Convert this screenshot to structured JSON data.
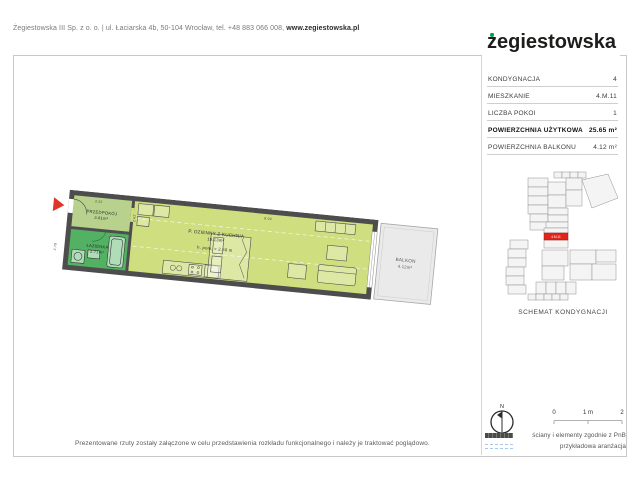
{
  "header": {
    "company_line": "Żegiestowska III Sp. z o. o. | ul. Łaciarska 4b, 50-104 Wrocław, tel. +48 883 066 008, ",
    "website": "www.zegiestowska.pl",
    "logo_first": "ż",
    "logo_rest": "egiestowska"
  },
  "info_table": {
    "rows": [
      {
        "label": "KONDYGNACJA",
        "value": "4"
      },
      {
        "label": "MIESZKANIE",
        "value": "4.M.11"
      },
      {
        "label": "LICZBA POKOI",
        "value": "1"
      },
      {
        "label": "POWIERZCHNIA UŻYTKOWA",
        "value": "25.65 m²"
      },
      {
        "label": "POWIERZCHNIA BALKONU",
        "value": "4.12 m²"
      }
    ]
  },
  "plan": {
    "rooms": [
      {
        "name": "PRZEDPOKÓJ",
        "area": "3.81m²"
      },
      {
        "name": "ŁAZIENKA",
        "area": "2.71m²"
      },
      {
        "name": "P. DZIENNY Z KUCHNIĄ",
        "area": "19.13m²",
        "height_note": "h. pom. = 2.60 m"
      },
      {
        "name": "BALKON",
        "area": "4.12m²"
      }
    ],
    "dimensions": [
      "2.61",
      "8.04",
      "2.62",
      "2.78"
    ],
    "colors": {
      "wall": "#4d4d4d",
      "hall_green": "#b8d28e",
      "bath_green": "#53b163",
      "living_green": "#cfdf80",
      "balcony_gray": "#eaeaea",
      "entrance_red": "#e0352b"
    }
  },
  "schematic": {
    "caption": "SCHEMAT KONDYGNACJI",
    "highlight_label": "4.M.11",
    "highlight_color": "#e0251b"
  },
  "legend": {
    "north_label": "N",
    "scale": {
      "start": "0",
      "mid": "1 m",
      "end": "2"
    },
    "items": [
      {
        "label": "ściany i elementy zgodnie z PnB"
      },
      {
        "label": "przykładowa aranżacja"
      }
    ]
  },
  "footer": {
    "disclaimer": "Prezentowane rzuty zostały załączone w celu przedstawienia rozkładu funkcjonalnego  i należy je traktować poglądowo."
  }
}
